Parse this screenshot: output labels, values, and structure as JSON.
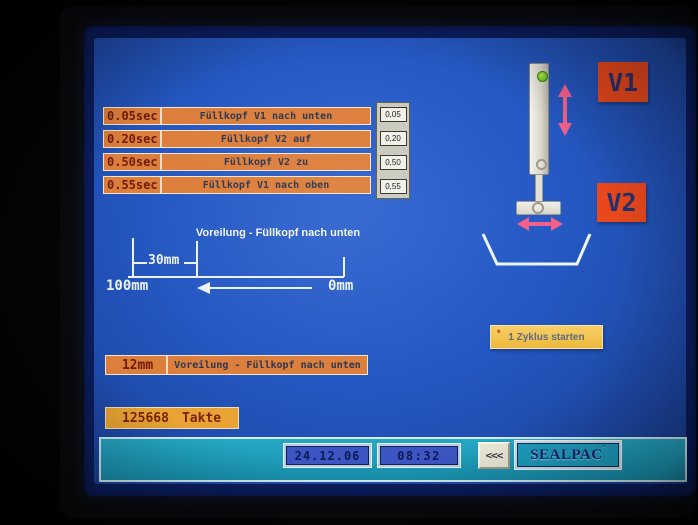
{
  "timers": {
    "rows": [
      {
        "value": "0.05sec",
        "label": "Füllkopf V1 nach unten",
        "setpoint": "0,05"
      },
      {
        "value": "0.20sec",
        "label": "Füllkopf V2 auf",
        "setpoint": "0,20"
      },
      {
        "value": "0.50sec",
        "label": "Füllkopf V2 zu",
        "setpoint": "0,50"
      },
      {
        "value": "0.55sec",
        "label": "Füllkopf V1 nach oben",
        "setpoint": "0,55"
      }
    ]
  },
  "valve_labels": {
    "v1": "V1",
    "v2": "V2"
  },
  "diagram": {
    "title": "Voreilung - Füllkopf nach unten",
    "segment": "30mm",
    "left": "100mm",
    "right": "0mm"
  },
  "cycle_button": {
    "marker": "*",
    "label": "1 Zyklus starten"
  },
  "advance": {
    "value": "12mm",
    "label": "Voreilung - Füllkopf nach unten"
  },
  "counter": {
    "value": "125668",
    "unit": "Takte"
  },
  "statusbar": {
    "date": "24.12.06",
    "time": "08:32",
    "back": "<<<",
    "brand": "SEALPAC",
    "brand_accent": "´"
  },
  "colors": {
    "screen_blue": "#2558c2",
    "frame_navy": "#0b1d5c",
    "row_orange": "#dd7f3c",
    "counter_orange": "#e9a334",
    "valve_tag_red": "#e8481c",
    "motion_arrow_pink": "#f2608a",
    "cycle_button_yellow": "#f2c34f",
    "statusbar_teal": "#1b9cba",
    "led_green": "#6cc426",
    "digital_maroon": "#6f1d05"
  }
}
